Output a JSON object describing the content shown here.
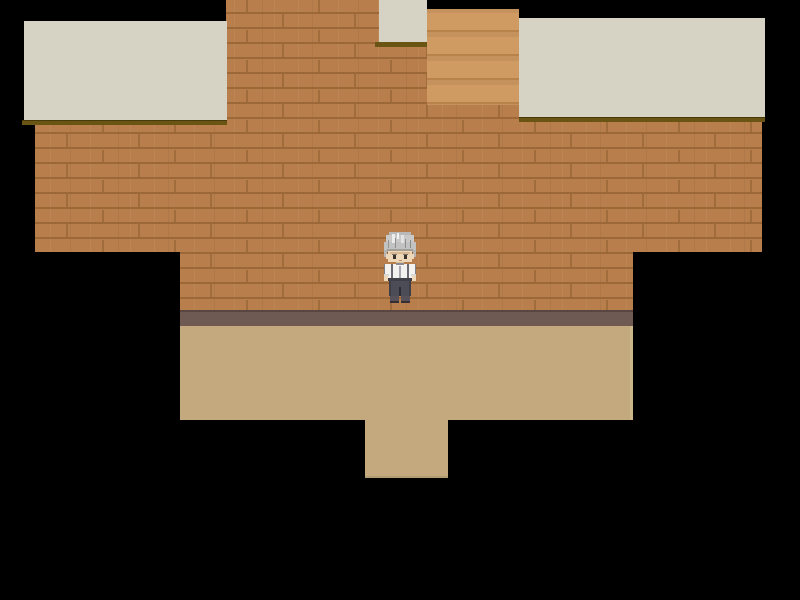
{
  "scene": {
    "view": "top-down-interior",
    "character": {
      "id": "elderly-man-sprite",
      "pose": "standing",
      "facing": "down"
    }
  },
  "colors": {
    "background": "#000000",
    "wall": "#b87e4c",
    "wall_seam": "#9c6838",
    "wall_joint": "#a06c3c",
    "ceiling": "#d6d3c5",
    "shadow_olive": "#6a5414",
    "shadow_dark": "#473908",
    "door": "#d09a63",
    "door_line": "#b9824c",
    "baseboard": "#6f5a53",
    "baseboard_line": "#594641",
    "floor": "#c3a97d",
    "floor_edge": "#cdb68b",
    "floor_edge_dark": "#b29c74",
    "hair": "#c9c9c9",
    "hair_light": "#ececec",
    "hair_dark": "#8f8f8f",
    "hair_shadow": "#a39f98",
    "skin": "#eed6b8",
    "skin_shadow": "#d9b993",
    "shirt": "#f3f2ee",
    "shirt_line": "#a7a7ad",
    "suspender": "#6a6a74",
    "belt": "#3f3f47",
    "pants": "#4c4c56",
    "pants_dark": "#2c2c32",
    "shoes": "#57525a",
    "eyes": "#39322c"
  }
}
